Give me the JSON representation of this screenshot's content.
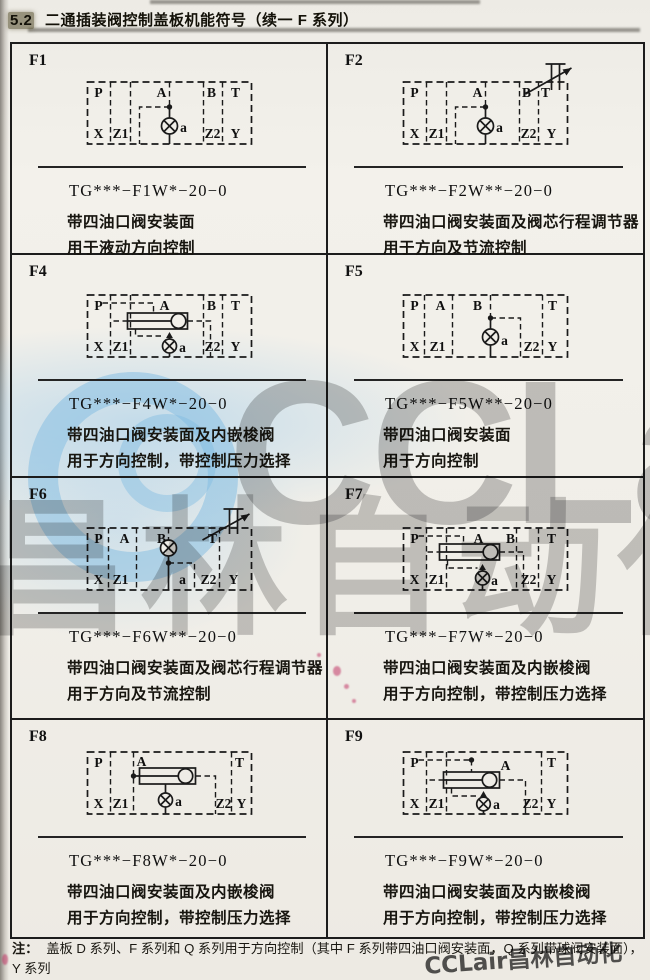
{
  "header": {
    "section": "5.2",
    "title": "二通插装阀控制盖板机能符号（续一  F 系列）"
  },
  "cells": [
    {
      "id": "F1",
      "code": "TG***−F1W*−20−0",
      "desc1": "带四油口阀安装面",
      "desc2": "用于液动方向控制",
      "ports": {
        "top": [
          "P",
          "A",
          "B",
          "T"
        ],
        "bottom": [
          "X",
          "Z1",
          "a",
          "Z2",
          "Y"
        ]
      }
    },
    {
      "id": "F2",
      "code": "TG***−F2W**−20−0",
      "desc1": "带四油口阀安装面及阀芯行程调节器",
      "desc2": "用于方向及节流控制",
      "ports": {
        "top": [
          "P",
          "A",
          "B",
          "T"
        ],
        "bottom": [
          "X",
          "Z1",
          "a",
          "Z2",
          "Y"
        ]
      }
    },
    {
      "id": "F4",
      "code": "TG***−F4W*−20−0",
      "desc1": "带四油口阀安装面及内嵌梭阀",
      "desc2": "用于方向控制，带控制压力选择",
      "ports": {
        "top": [
          "P",
          "A",
          "B",
          "T"
        ],
        "bottom": [
          "X",
          "Z1",
          "a",
          "Z2",
          "Y"
        ]
      }
    },
    {
      "id": "F5",
      "code": "TG***−F5W**−20−0",
      "desc1": "带四油口阀安装面",
      "desc2": "用于方向控制",
      "ports": {
        "top": [
          "P",
          "A",
          "B",
          "T"
        ],
        "bottom": [
          "X",
          "Z1",
          "a",
          "Z2",
          "Y"
        ]
      }
    },
    {
      "id": "F6",
      "code": "TG***−F6W**−20−0",
      "desc1": "带四油口阀安装面及阀芯行程调节器",
      "desc2": "用于方向及节流控制",
      "ports": {
        "top": [
          "P",
          "A",
          "B",
          "T"
        ],
        "bottom": [
          "X",
          "Z1",
          "a",
          "Z2",
          "Y"
        ]
      }
    },
    {
      "id": "F7",
      "code": "TG***−F7W*−20−0",
      "desc1": "带四油口阀安装面及内嵌梭阀",
      "desc2": "用于方向控制，带控制压力选择",
      "ports": {
        "top": [
          "P",
          "A",
          "B",
          "T"
        ],
        "bottom": [
          "X",
          "Z1",
          "a",
          "Z2",
          "Y"
        ]
      }
    },
    {
      "id": "F8",
      "code": "TG***−F8W*−20−0",
      "desc1": "带四油口阀安装面及内嵌梭阀",
      "desc2": "用于方向控制，带控制压力选择",
      "ports": {
        "top": [
          "P",
          "A",
          "T"
        ],
        "bottom": [
          "X",
          "Z1",
          "a",
          "Z2",
          "Y"
        ]
      }
    },
    {
      "id": "F9",
      "code": "TG***−F9W*−20−0",
      "desc1": "带四油口阀安装面及内嵌梭阀",
      "desc2": "用于方向控制，带控制压力选择",
      "ports": {
        "top": [
          "P",
          "A",
          "T"
        ],
        "bottom": [
          "X",
          "Z1",
          "a",
          "Z2",
          "Y"
        ]
      }
    }
  ],
  "note": {
    "label": "注：",
    "line1": "盖板 D 系列、F 系列和 Q 系列用于方向控制（其中 F 系列带四油口阀安装面，Q 系列带球阀安装面），Y 系列",
    "line2": "用于压力控制；J 系列用于组成减压控制单元。"
  },
  "watermarks": {
    "latin": "CCLair",
    "chinese": "昌林自动化",
    "corner": "CCLair昌林自动化"
  },
  "colors": {
    "paper": "#f1efe9",
    "ink": "#1a1a1a",
    "logo_blue": "#80bce2",
    "wm_gray": "#767676"
  }
}
